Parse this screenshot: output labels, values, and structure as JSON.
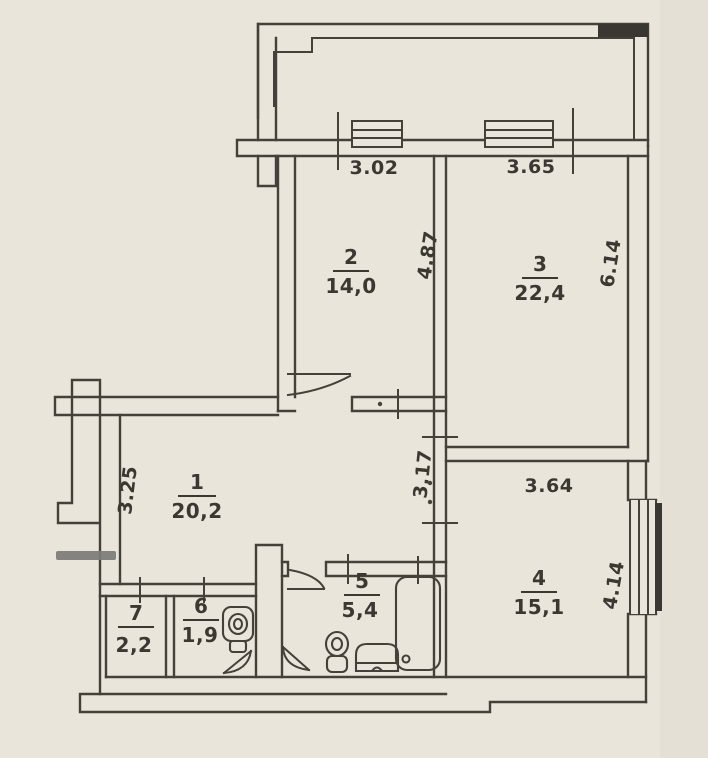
{
  "plan_type": "apartment-floor-plan",
  "rooms": {
    "r1": {
      "number": "1",
      "area": "20,2"
    },
    "r2": {
      "number": "2",
      "area": "14,0"
    },
    "r3": {
      "number": "3",
      "area": "22,4"
    },
    "r4": {
      "number": "4",
      "area": "15,1"
    },
    "r5": {
      "number": "5",
      "area": "5,4"
    },
    "r6": {
      "number": "6",
      "area": "1,9"
    },
    "r7": {
      "number": "7",
      "area": "2,2"
    }
  },
  "dims": {
    "top_left": "3.02",
    "top_right": "3.65",
    "room2_depth": "4.87",
    "room3_depth": "6.14",
    "room1_left": "3.25",
    "corridor": "3.17",
    "room4_width": "3.64",
    "room4_right": "4.14"
  },
  "fixtures": [
    "toilet-icon",
    "toilet-icon",
    "sink-icon",
    "bathtub-icon"
  ],
  "colors": {
    "paper": "#e9e5da",
    "ink": "#45413a",
    "marker": "#7b7b78"
  }
}
